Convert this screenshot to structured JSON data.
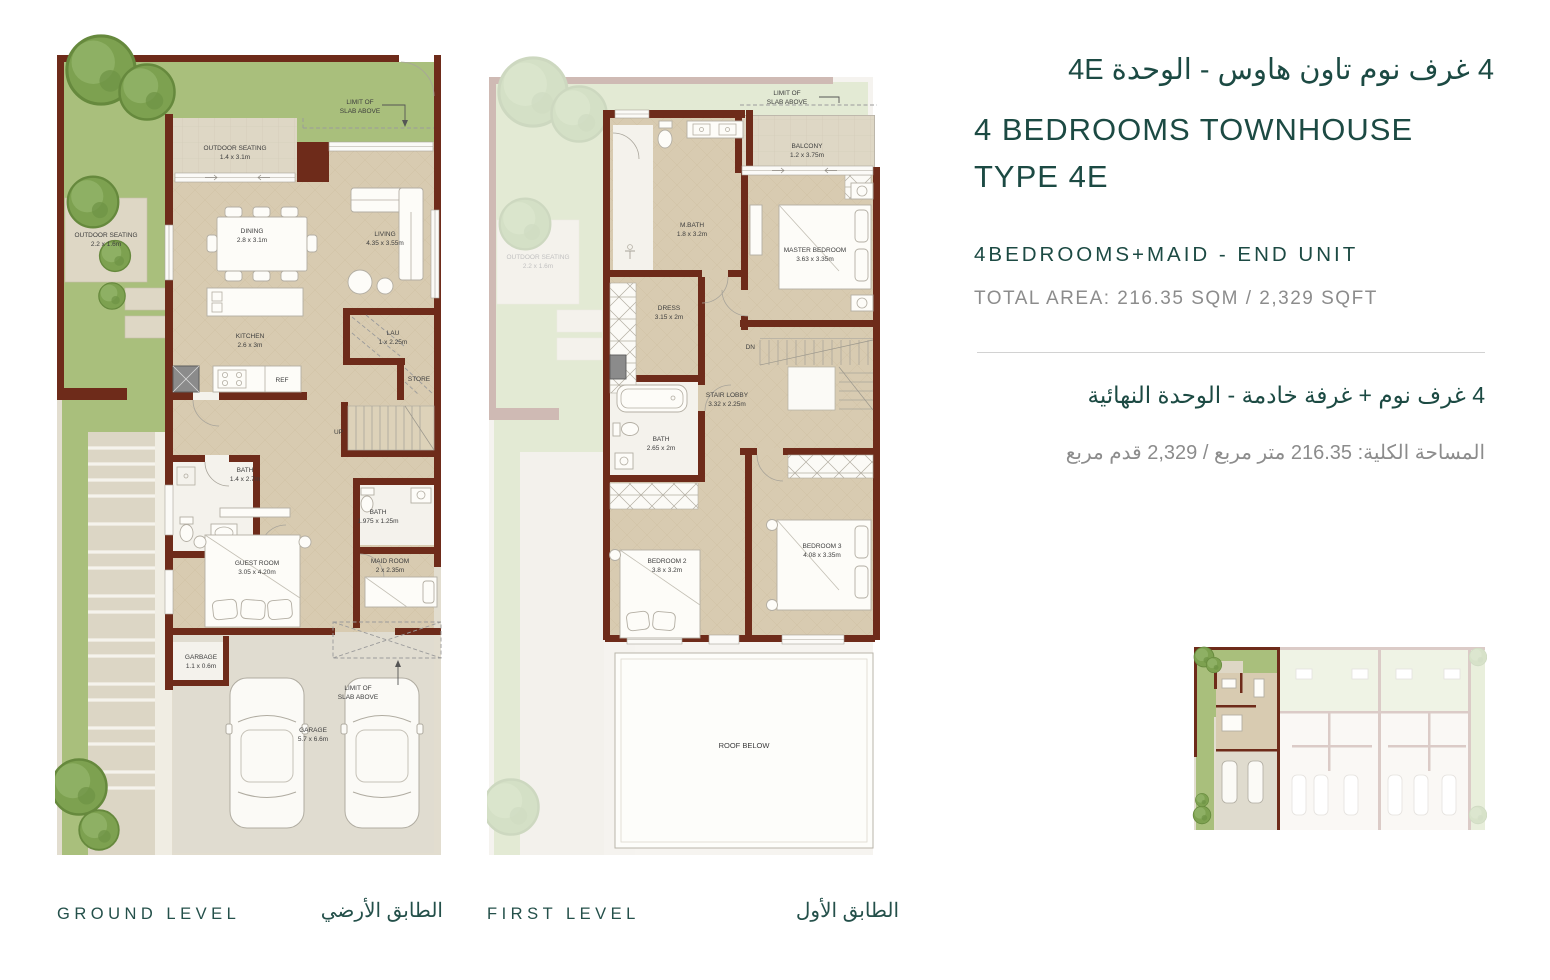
{
  "header": {
    "title_ar": "4 غرف نوم تاون هاوس - الوحدة 4E",
    "title_en_line1": "4 BEDROOMS TOWNHOUSE",
    "title_en_line2": "TYPE 4E",
    "unit_en": "4BEDROOMS+MAID - END UNIT",
    "area_en": "TOTAL AREA: 216.35 SQM / 2,329 SQFT",
    "unit_ar": "4 غرف نوم + غرفة خادمة - الوحدة النهائية",
    "area_ar": "المساحة الكلية: 216.35 متر مربع / 2,329 قدم مربع"
  },
  "ground": {
    "caption_en": "GROUND LEVEL",
    "caption_ar": "الطابق الأرضي",
    "limit1": "LIMIT OF",
    "limit2": "SLAB ABOVE",
    "rooms": {
      "outdoor_top": {
        "name": "OUTDOOR SEATING",
        "dims": "1.4 x 3.1m"
      },
      "outdoor_left": {
        "name": "OUTDOOR SEATING",
        "dims": "2.2 x 1.6m"
      },
      "dining": {
        "name": "DINING",
        "dims": "2.8 x 3.1m"
      },
      "living": {
        "name": "LIVING",
        "dims": "4.35 x 3.55m"
      },
      "kitchen": {
        "name": "KITCHEN",
        "dims": "2.6 x 3m"
      },
      "ref": {
        "name": "REF"
      },
      "lau": {
        "name": "LAU",
        "dims": "1 x 2.25m"
      },
      "store": {
        "name": "STORE"
      },
      "up": {
        "name": "UP"
      },
      "bath1": {
        "name": "BATH",
        "dims": "1.4 x 2.7m"
      },
      "bath2": {
        "name": "BATH",
        "dims": "1.975 x 1.25m"
      },
      "guest": {
        "name": "GUEST ROOM",
        "dims": "3.05 x 4.20m"
      },
      "maid": {
        "name": "MAID ROOM",
        "dims": "2 x 2.35m"
      },
      "garbage": {
        "name": "GARBAGE",
        "dims": "1.1 x 0.6m"
      },
      "garage": {
        "name": "GARAGE",
        "dims": "5.7 x 6.6m"
      }
    }
  },
  "first": {
    "caption_en": "FIRST LEVEL",
    "caption_ar": "الطابق الأول",
    "limit1": "LIMIT OF",
    "limit2": "SLAB ABOVE",
    "rooms": {
      "outdoor_top": {
        "name": "OUTDOOR SEATING",
        "dims": "1.4 x 3.1m"
      },
      "outdoor_left": {
        "name": "OUTDOOR SEATING",
        "dims": "2.2 x 1.6m"
      },
      "balcony": {
        "name": "BALCONY",
        "dims": "1.2 x 3.75m"
      },
      "mbath": {
        "name": "M.BATH",
        "dims": "1.8 x 3.2m"
      },
      "master": {
        "name": "MASTER BEDROOM",
        "dims": "3.63 x 3.35m"
      },
      "dress": {
        "name": "DRESS",
        "dims": "3.15 x 2m"
      },
      "stair": {
        "name": "STAIR LOBBY",
        "dims": "3.32 x 2.25m"
      },
      "dn": {
        "name": "DN"
      },
      "bath": {
        "name": "BATH",
        "dims": "2.65 x 2m"
      },
      "bedroom2": {
        "name": "BEDROOM 2",
        "dims": "3.8 x 3.2m"
      },
      "bedroom3": {
        "name": "BEDROOM 3",
        "dims": "4.08 x 3.35m"
      },
      "roof": {
        "name": "ROOF BELOW"
      }
    }
  },
  "colors": {
    "accent_teal": "#1c4a43",
    "muted_gray": "#8c8c8c",
    "wall_brown": "#6e2b1a",
    "floor_tan": "#d8cbb1",
    "deck_beige": "#ded7c5",
    "garden_green": "#a9bf7c",
    "tree_green": "#7da150",
    "pavement": "#e2ddcf"
  }
}
